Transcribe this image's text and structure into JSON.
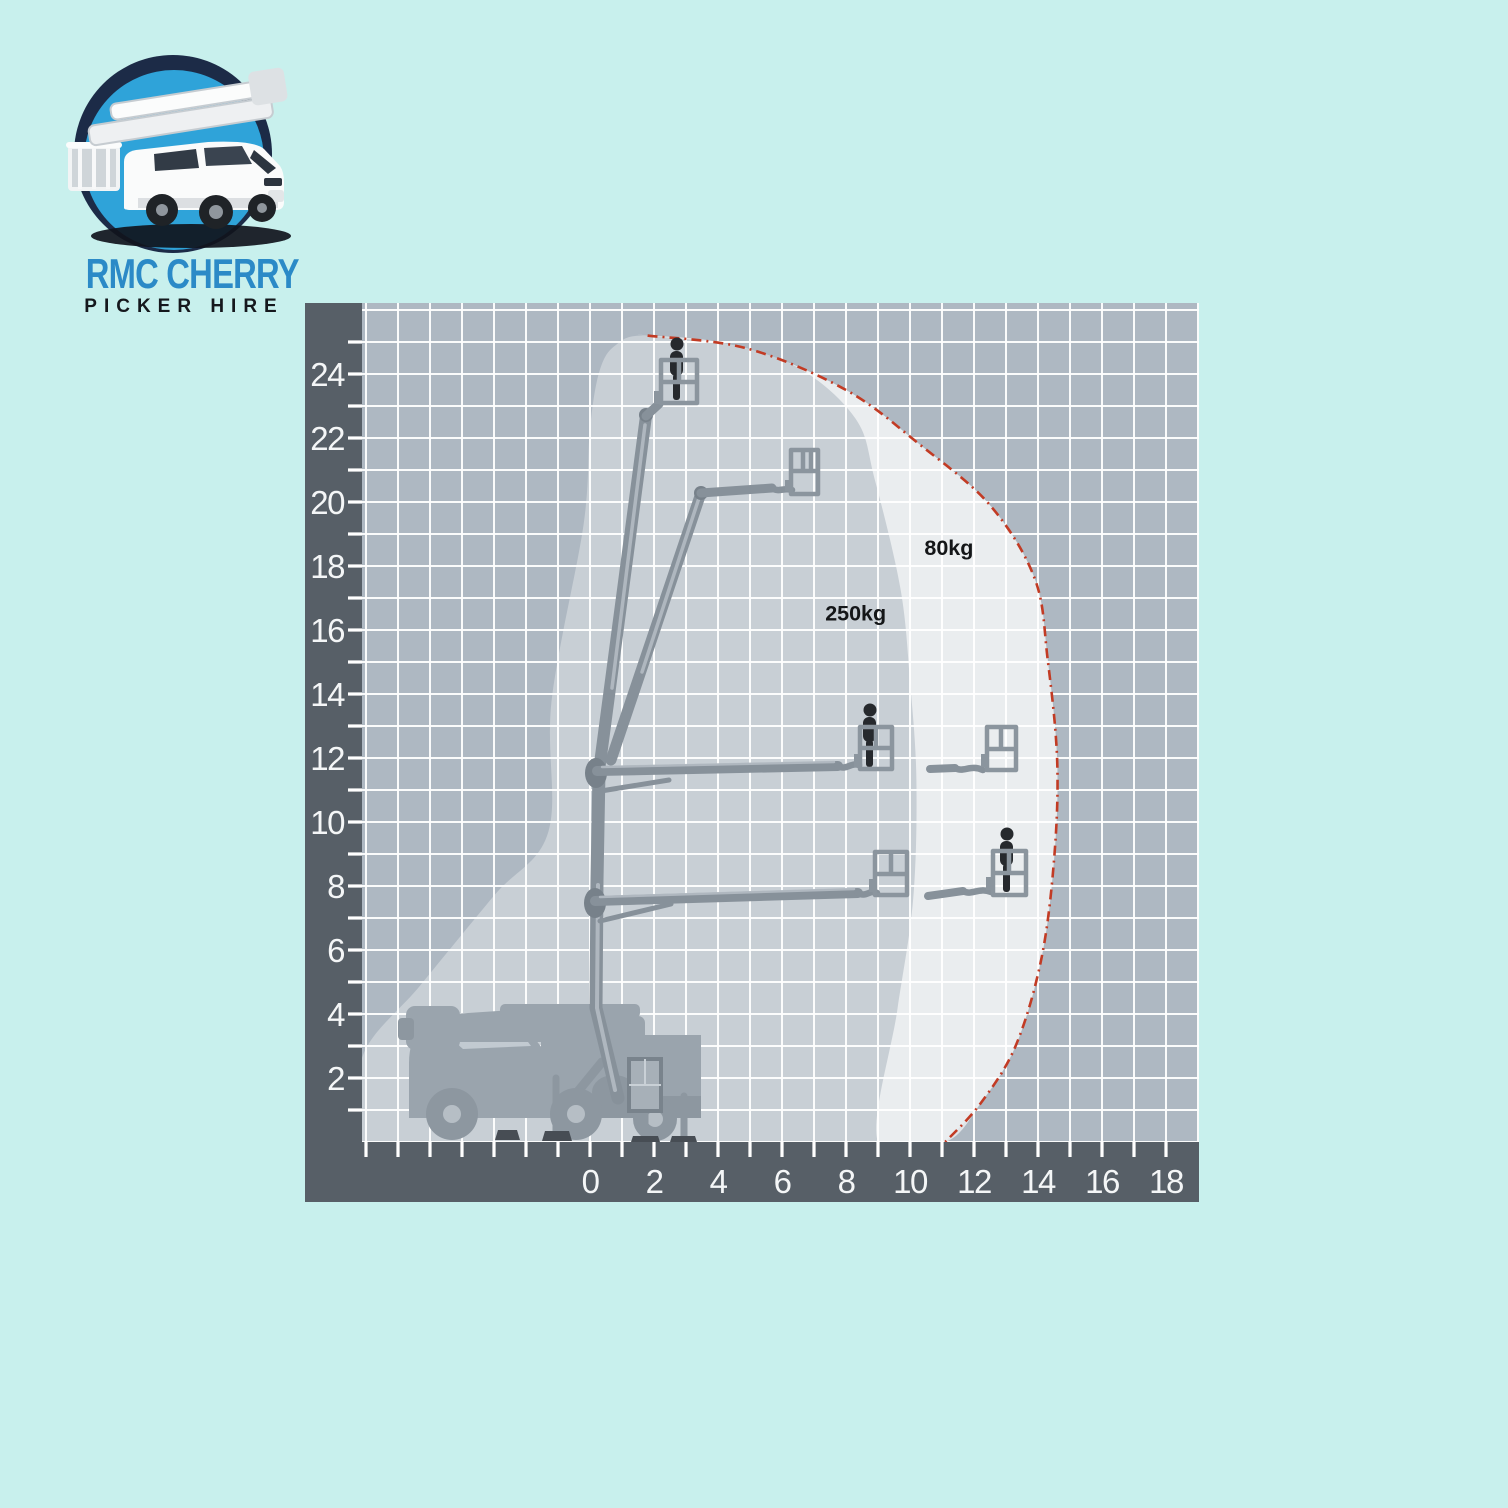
{
  "colors": {
    "page_bg": "#c8f0ed",
    "frame": "#575f67",
    "grid_bg": "#aeb8c2",
    "grid_line": "#ffffff",
    "axis_text": "#f4f6f7",
    "zone_text": "#141618",
    "envelope_outline": "#c23b24",
    "boom": "#87919a",
    "boom_joint": "#77818a",
    "basket": "#8b959e",
    "person": "#26292d",
    "truck": "#9aa4ad",
    "truck_dark": "#8d97a0",
    "outrigger_foot": "#474d54",
    "logo_navy": "#1c2b47",
    "logo_blue": "#2fa3d9",
    "logo_title": "#2b8ac7",
    "logo_subtitle": "#15181d"
  },
  "logo": {
    "title": "RMC CHERRY",
    "subtitle": "PICKER HIRE"
  },
  "chart_data": {
    "type": "reach-envelope-diagram",
    "x_axis": {
      "tick_labels": [
        0,
        2,
        4,
        6,
        8,
        10,
        12,
        14,
        16,
        18
      ],
      "minor_step": 1,
      "range": [
        -7,
        19
      ]
    },
    "y_axis": {
      "tick_labels": [
        2,
        4,
        6,
        8,
        10,
        12,
        14,
        16,
        18,
        20,
        22,
        24
      ],
      "minor_step": 1,
      "range": [
        0,
        26
      ]
    },
    "zones": [
      {
        "label": "250kg",
        "label_pos_m": [
          7.35,
          16.3
        ]
      },
      {
        "label": "80kg",
        "label_pos_m": [
          10.45,
          18.35
        ]
      }
    ],
    "outline_m": [
      [
        1.8,
        25.2
      ],
      [
        4.9,
        24.8
      ],
      [
        8.0,
        23.5
      ],
      [
        10.3,
        21.8
      ],
      [
        12.5,
        19.9
      ],
      [
        13.9,
        17.6
      ],
      [
        14.3,
        15.1
      ],
      [
        14.6,
        11.9
      ],
      [
        14.5,
        8.8
      ],
      [
        14.1,
        5.7
      ],
      [
        13.3,
        3.0
      ],
      [
        12.2,
        1.2
      ],
      [
        11.1,
        0.0
      ]
    ],
    "inner_boundary_m": [
      [
        1.8,
        25.2
      ],
      [
        4.0,
        25.0
      ],
      [
        6.5,
        24.2
      ],
      [
        8.3,
        22.6
      ],
      [
        8.9,
        20.7
      ],
      [
        9.7,
        17.3
      ],
      [
        10.0,
        14.4
      ],
      [
        10.2,
        11.3
      ],
      [
        10.1,
        7.6
      ],
      [
        9.6,
        4.1
      ],
      [
        9.0,
        0.0
      ]
    ],
    "left_edge_m": [
      [
        -7.2,
        0.0
      ],
      [
        -7.1,
        2.7
      ],
      [
        -5.3,
        4.9
      ],
      [
        -3.0,
        7.7
      ],
      [
        -1.3,
        9.7
      ],
      [
        -1.2,
        13.8
      ],
      [
        -0.2,
        19.3
      ],
      [
        0.0,
        22.3
      ],
      [
        0.3,
        24.1
      ],
      [
        0.8,
        24.9
      ]
    ]
  }
}
